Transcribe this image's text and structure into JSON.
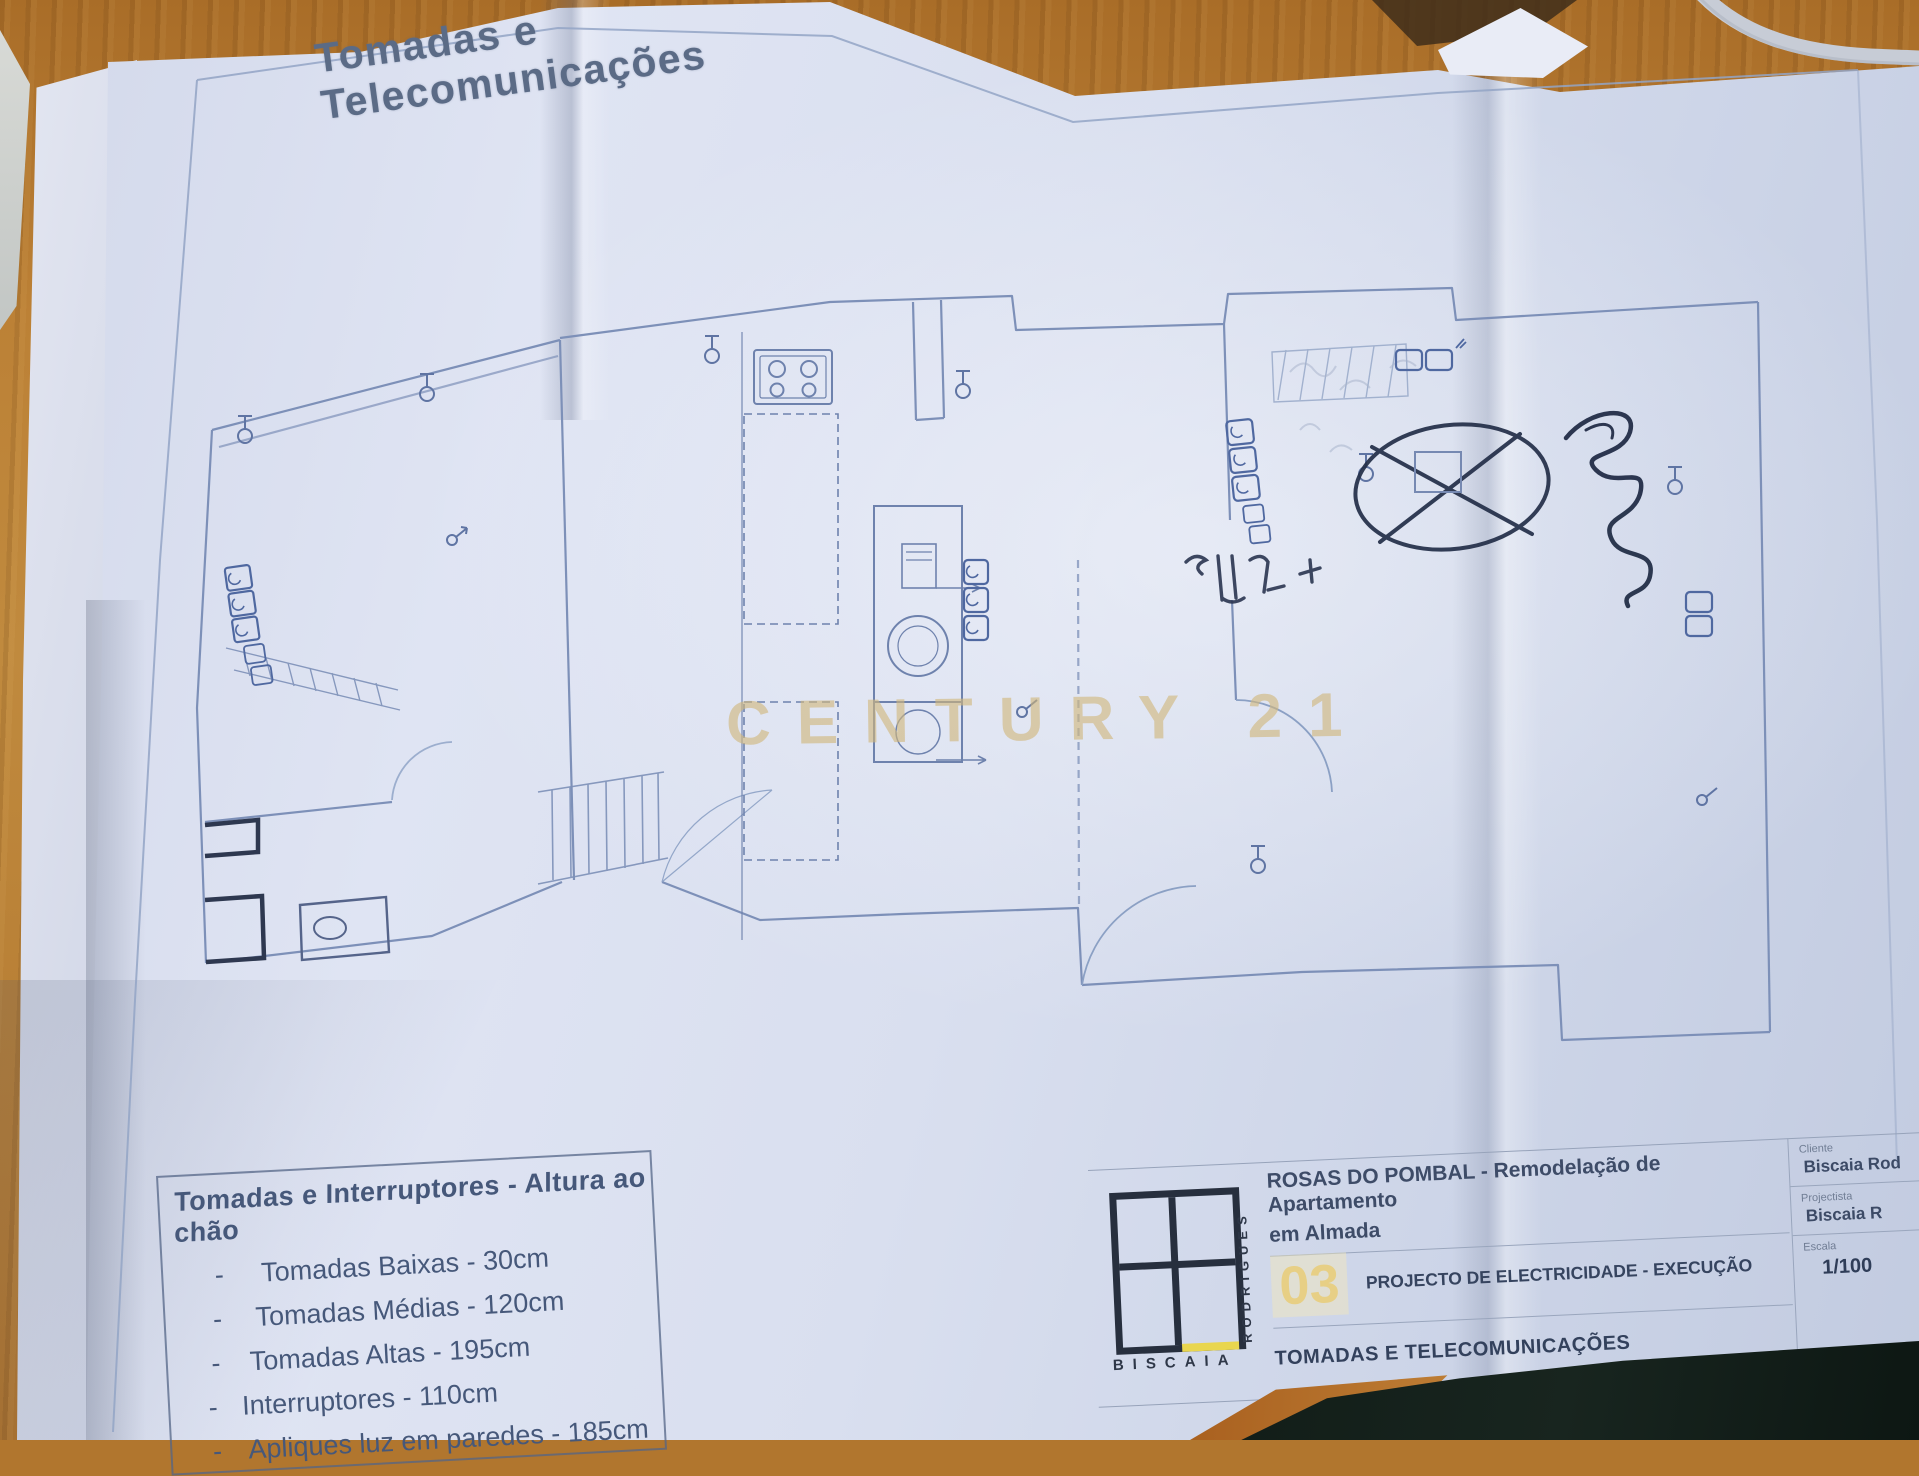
{
  "plan": {
    "title": "Tomadas e Telecomunicações",
    "watermark": "CENTURY 21"
  },
  "legend": {
    "title": "Tomadas e Interruptores - Altura ao chão",
    "dash": "-",
    "items": [
      "Tomadas Baixas - 30cm",
      "Tomadas Médias - 120cm",
      "Tomadas Altas - 195cm",
      "Interruptores - 110cm",
      "Apliques luz em paredes  - 185cm"
    ]
  },
  "title_block": {
    "logo_word_horizontal": "BISCAIA",
    "logo_word_vertical": "RODRIGUES",
    "project_line1": "ROSAS DO POMBAL - Remodelação de Apartamento",
    "project_line2": "em  Almada",
    "sheet_number": "03",
    "subject": "PROJECTO DE ELECTRICIDADE - EXECUÇÃO",
    "sheet_name": "TOMADAS E TELECOMUNICAÇÕES",
    "client_label": "Cliente",
    "client_value": "Biscaia Rod",
    "designer_label": "Projectista",
    "designer_value": "Biscaia R",
    "scale_label": "Escala",
    "scale_value": "1/100",
    "footer": "BISCAIA RODRIGUES | WWW.BISCAIARODRIGUES.COM"
  },
  "colors": {
    "paper": "#d9dfef",
    "plan_line": "#7d90b8",
    "pen_ink": "#232e48",
    "watermark_gold": "#d1b77a",
    "logo_accent_yellow": "#e9d64f",
    "wood": "#b1762e",
    "dark_object": "#18251f"
  }
}
